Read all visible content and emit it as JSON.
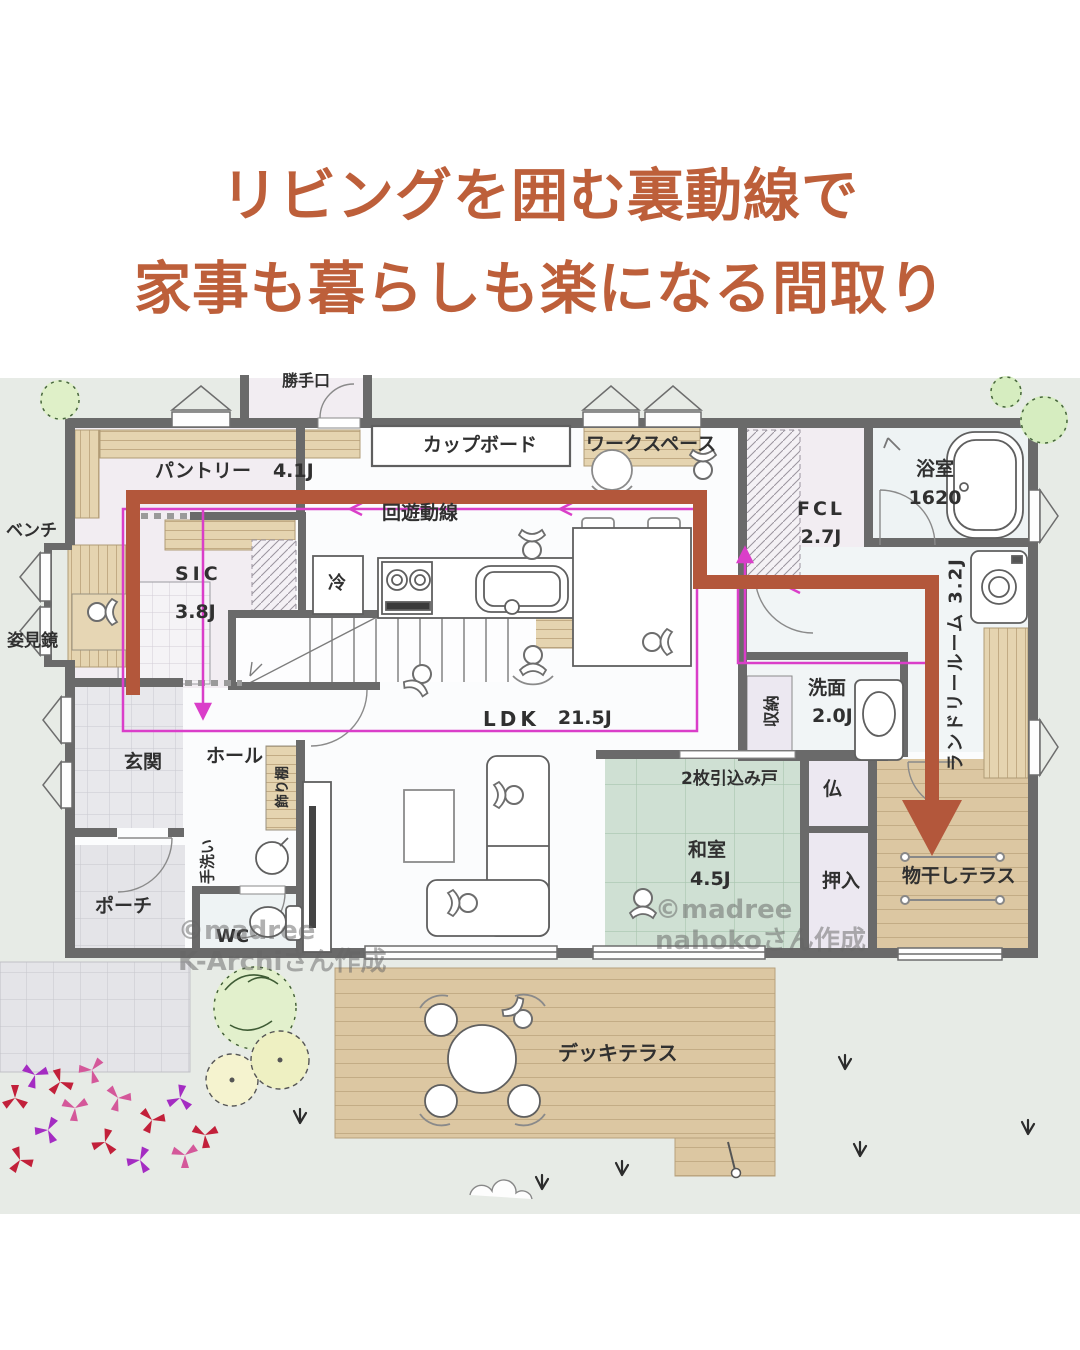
{
  "title": {
    "line1": "リビングを囲む裏動線で",
    "line2": "家事も暮らしも楽になる間取り"
  },
  "colors": {
    "title_text": "#bd5f3a",
    "flow_arrow": "#b3573b",
    "circulation_line": "#da3ec9",
    "wall": "#6a6a6a",
    "tatami": "#cfe0d3",
    "wood_deck": "#dcc7a2",
    "exterior_bg": "#e7ebe6"
  },
  "rooms": {
    "pantry": {
      "label": "パントリー",
      "size": "4.1J"
    },
    "sic": {
      "label": "SIC",
      "size": "3.8J"
    },
    "fcl": {
      "label": "FCL",
      "size": "2.7J"
    },
    "bathroom": {
      "label": "浴室",
      "size": "1620"
    },
    "laundry": {
      "label": "ランドリールーム 3.2J"
    },
    "washroom": {
      "label": "洗面",
      "size": "2.0J"
    },
    "ldk": {
      "label": "LDK",
      "size": "21.5J"
    },
    "washitsu": {
      "label": "和室",
      "size": "4.5J"
    },
    "genkan": {
      "label": "玄関"
    },
    "hall": {
      "label": "ホール"
    },
    "porch": {
      "label": "ポーチ"
    },
    "wc": {
      "label": "WC"
    },
    "deck_terrace": {
      "label": "デッキテラス"
    },
    "drying_terrace": {
      "label": "物干しテラス"
    },
    "butsudan": {
      "label": "仏"
    },
    "oshiire": {
      "label": "押入"
    },
    "storage": {
      "label": "収納"
    }
  },
  "features": {
    "circulation": "回遊動線",
    "cupboard": "カップボード",
    "workspace": "ワークスペース",
    "back_door": "勝手口",
    "fridge": "冷",
    "bench": "ベンチ",
    "mirror": "姿見鏡",
    "hand_wash": "手洗い",
    "display_shelf": "飾り棚",
    "sliding_door": "2枚引込み戸"
  },
  "watermarks": {
    "left_line1": "©madree",
    "left_line2": "K-Archiさん作成",
    "right_line1": "©madree",
    "right_line2": "nahokoさん作成"
  }
}
